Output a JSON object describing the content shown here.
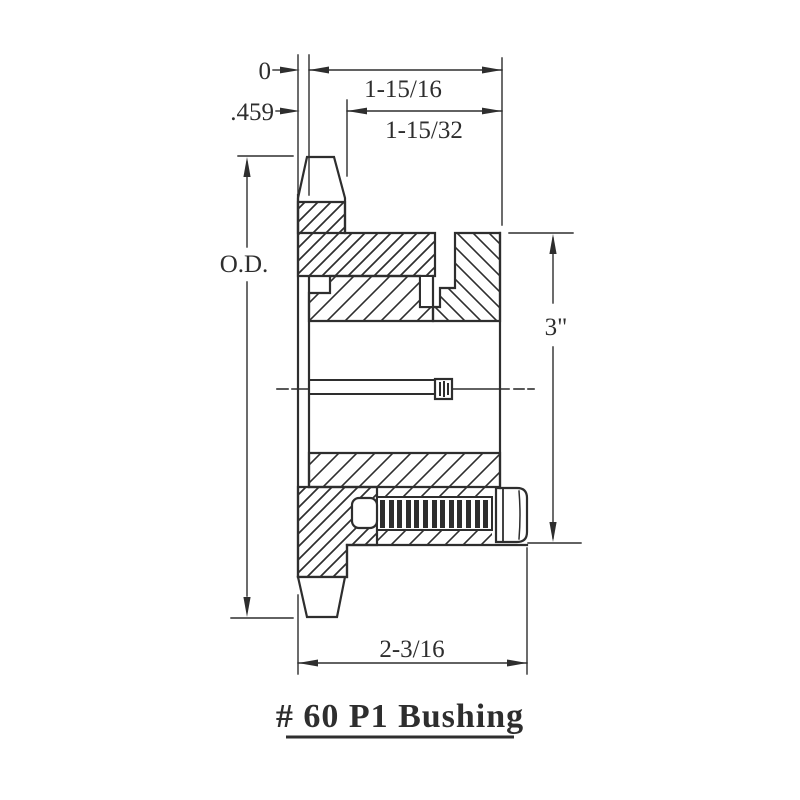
{
  "drawing": {
    "title": "# 60 P1 Bushing",
    "labels": {
      "zero": "0",
      "offset": ".459",
      "outer_width": "1-15/16",
      "inner_width": "1-15/32",
      "od": "O.D.",
      "flange_od": "3\"",
      "overall_width": "2-3/16"
    },
    "colors": {
      "ink": "#2e2e2e",
      "background": "#ffffff"
    }
  }
}
